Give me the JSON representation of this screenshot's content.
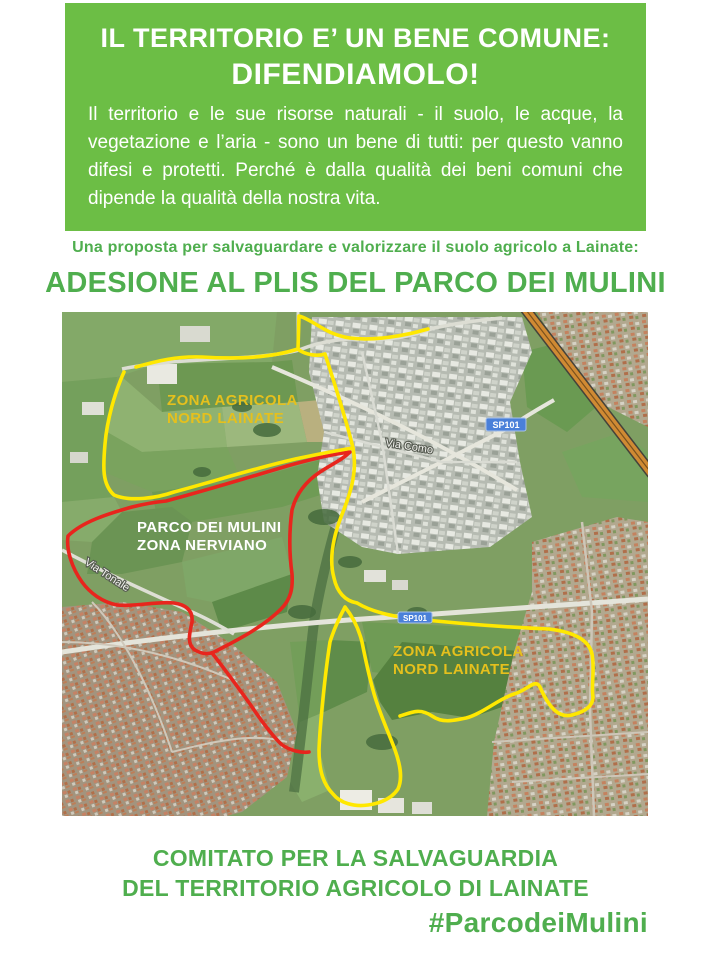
{
  "header": {
    "title_line1": "IL TERRITORIO E’ UN BENE COMUNE:",
    "title_line2": "DIFENDIAMOLO!",
    "body": "Il territorio e le sue risorse naturali - il suolo, le acque, la vegetazione e l’aria - sono un bene di tutti: per questo vanno difesi e protetti. Perché è dalla qualità dei beni comuni che dipende la qualità della nostra vita."
  },
  "proposta": "Una proposta per salvaguardare e valorizzare il suolo agricolo a Lainate:",
  "main_title": "ADESIONE AL PLIS DEL PARCO DEI MULINI",
  "map": {
    "labels": {
      "zona_agricola_top": {
        "line1": "ZONA AGRICOLA",
        "line2": "NORD LAINATE"
      },
      "parco": {
        "line1": "PARCO DEI MULINI",
        "line2": "ZONA NERVIANO"
      },
      "zona_agricola_bottom": {
        "line1": "ZONA AGRICOLA",
        "line2": "NORD LAINATE"
      },
      "via_como": "Via Como",
      "via_tonale": "Via Tonale",
      "sp101_top": "SP101",
      "sp101_bottom": "SP101"
    }
  },
  "footer": {
    "line1": "COMITATO PER LA SALVAGUARDIA",
    "line2": "DEL TERRITORIO AGRICOLO DI LAINATE",
    "hashtag": "#ParcodeiMulini"
  },
  "colors": {
    "green_block": "#6cbe45",
    "green_text": "#4fae4e",
    "yellow_line": "#ffe800",
    "red_line": "#e8251d",
    "label_yellow": "#e5c01d",
    "badge_blue": "#4a80d9"
  }
}
